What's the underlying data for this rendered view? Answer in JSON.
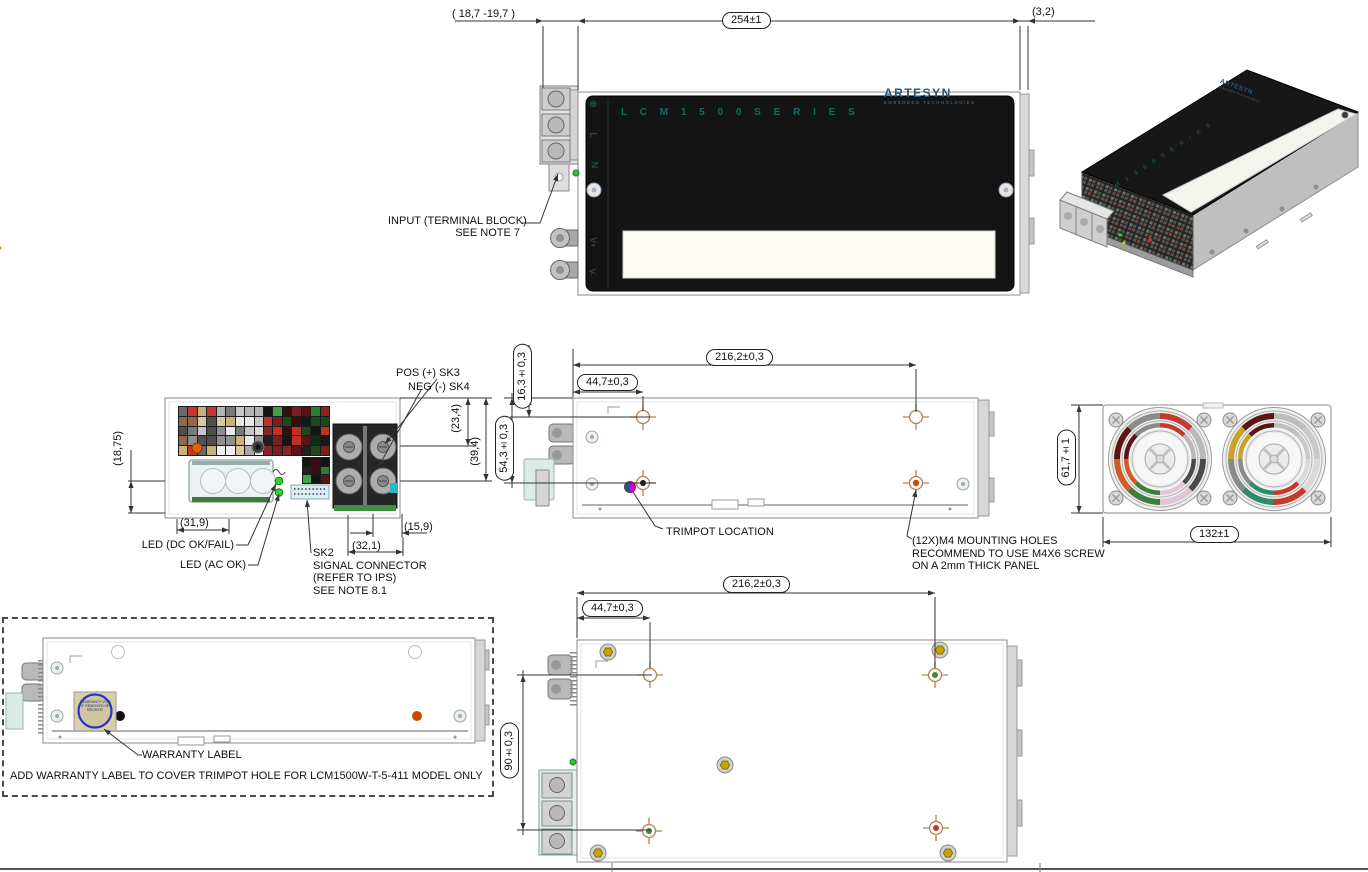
{
  "drawing": {
    "series_text": "L C M 1 5 0 0 S E R I E S",
    "brand": "ARTESYN",
    "brand_sub": "EMBEDDED TECHNOLOGIES",
    "panel": {
      "ground": "⊕",
      "line": "L",
      "neutral": "N",
      "vplus": "V+",
      "vminus": "V-"
    }
  },
  "dimensions": {
    "top_overhang": "( 18,7  -19,7 )",
    "top_length": "254±1",
    "top_right": "(3,2)",
    "front_left": "(18,75)",
    "front_bottom_left": "(31,9)",
    "front_stud_row1": "(23,4)",
    "front_stud_row2": "(39,4)",
    "front_stud_span": "(32,1)",
    "front_stud_pitch": "(15,9)",
    "side_hole_span": "216,2±0,3",
    "side_hole_offset": "44,7±0,3",
    "side_top_offset": "16,3±0,3",
    "side_height_offset": "54,3±0,3",
    "rear_height": "61,7±1",
    "rear_width": "132±1",
    "bottom_hole_span": "216,2±0,3",
    "bottom_hole_offset": "44,7±0,3",
    "bottom_hole_vspan": "90±0,3"
  },
  "callouts": {
    "input_line1": "INPUT (TERMINAL BLOCK)",
    "input_line2": "SEE NOTE 7",
    "pos_stud": "POS (+) SK3",
    "neg_stud": "NEG (-) SK4",
    "led_dc": "LED (DC OK/FAIL)",
    "led_ac": "LED (AC OK)",
    "sk2_line1": "SK2",
    "sk2_line2": "SIGNAL CONNECTOR",
    "sk2_line3": "(REFER TO IPS)",
    "sk2_line4": "SEE NOTE 8.1",
    "trimpot": "TRIMPOT LOCATION",
    "m4_line1": "(12X)M4 MOUNTING HOLES",
    "m4_line2": "RECOMMEND TO USE M4X6 SCREW",
    "m4_line3": "ON A 2mm THICK PANEL",
    "warranty_callout": "WARRANTY LABEL",
    "warranty_note": "ADD WARRANTY LABEL TO COVER TRIMPOT HOLE FOR LCM1500W-T-5-411 MODEL ONLY",
    "warranty_seal": "\"WARRANTY VOID IF REMOVED OR BROKEN\""
  },
  "colors": {
    "cover_black": "#151515",
    "series_teal": "#1a6868",
    "brand_blue": "#20577f",
    "led_green": "#2fd32f",
    "trimpot_magenta": "#d400d4",
    "hole_tan": "#b5824f",
    "hole_orange": "#cc4a00",
    "hole_green": "#3a8a3a",
    "hole_red": "#c0392b",
    "screw_gold": "#c8a400",
    "warranty_blue": "#2a35c8"
  },
  "decor": {
    "vent_light": [
      "#b5b5b5",
      "#8f8f8f",
      "#d9d9d9",
      "#6a6a6a",
      "#eeeeee",
      "#c7c7c7",
      "#4f4f4f",
      "#d8c9a2",
      "#c8b27a",
      "#a8a8a8",
      "#e8e8e8",
      "#7a7a7a",
      "#c0392b",
      "#8f6a4a"
    ],
    "vent_dark": [
      "#5a1414",
      "#7a1f1f",
      "#151515",
      "#1d4a1d",
      "#2e7d32",
      "#45a049",
      "#c03028",
      "#101820",
      "#3a0d0d",
      "#0f2d0f",
      "#202020",
      "#8a2525"
    ]
  }
}
